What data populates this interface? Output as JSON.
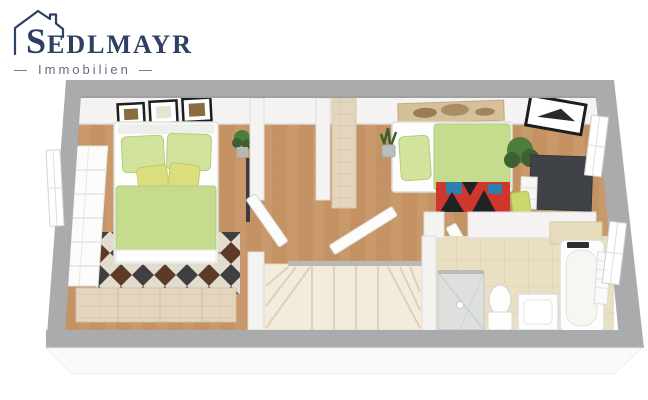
{
  "logo": {
    "initial": "S",
    "rest": "EDLMAYR",
    "tagline": "Immobilien",
    "dash": "—"
  },
  "palette": {
    "brand": "#2e3f63",
    "tagline": "#5f6d85",
    "outerWall": "#a9abad",
    "outerWallDark": "#9a9c9e",
    "innerWall": "#f4f3f1",
    "wallEdge": "#dedddb",
    "wood": "#c9996b",
    "woodDark": "#b0814f",
    "woodPale": "#e3d6bd",
    "woodPaleLine": "#cfbf9f",
    "bathTile": "#e9e0c3",
    "tileLine": "#d9cda8",
    "stair": "#f3ebdc",
    "stairLine": "#ddd1b6",
    "bedGreen": "#c5dc8e",
    "pillowGreen": "#d2e49c",
    "cushionYellow": "#dade7e",
    "duvetEdge": "#b2cd7c",
    "rugCream": "#e2dccf",
    "rugDark": "#403e41",
    "rugBrown": "#5d3a25",
    "rugRed": "#d0372c",
    "rugBlue": "#2f7fae",
    "rugBlack": "#222225",
    "desk": "#3f4347",
    "lime": "#cbd96b",
    "plant": "#4e7c3a",
    "plantDark": "#3c6030",
    "glass": "#dde0dc",
    "glassLine": "#c2c7c3",
    "white": "#fdfdfc",
    "slab": "#fafafa",
    "artTan": "#d6c09a",
    "artDark": "#8a6b42",
    "frameBlack": "#1d1d1f"
  }
}
